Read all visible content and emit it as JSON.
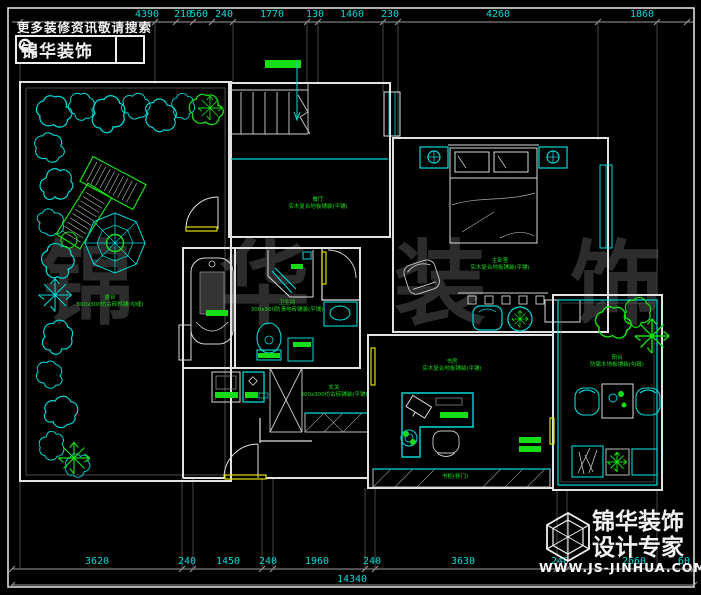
{
  "header": {
    "tagline": "更多装修资讯敬请搜索",
    "brand": "锦华装饰",
    "search_icon": "magnifier-icon"
  },
  "watermark": {
    "text": "锦华装饰",
    "chars": [
      "锦",
      "华",
      "装",
      "饰"
    ]
  },
  "footer": {
    "brand": "锦华装饰",
    "subtitle": "设计专家",
    "website": "WWW.JS-JINHUA.COM",
    "logo_icon": "cube-logo-icon"
  },
  "dimensions": {
    "top": [
      "4390",
      "210",
      "560",
      "240",
      "1770",
      "130",
      "1460",
      "230",
      "4260",
      "1860"
    ],
    "bottom": [
      "3620",
      "240",
      "1450",
      "240",
      "1960",
      "240",
      "3630",
      "240",
      "2660",
      "60"
    ],
    "total": "14340"
  },
  "rooms": {
    "terrace": {
      "name": "露台",
      "finish": "300x300仿古砖斜铺(勾缝)"
    },
    "dining": {
      "name": "餐厅",
      "finish": "实木复合地板铺装(平铺)"
    },
    "master_bedroom": {
      "name": "主卧室",
      "finish": "实木复合地板铺装(平铺)"
    },
    "bathroom": {
      "name": "卫生间",
      "finish": "300x300防滑地砖铺装(平铺)"
    },
    "hallway": {
      "name": "玄关",
      "finish": "300x300仿古砖铺装(平铺)"
    },
    "study": {
      "name": "书房",
      "finish": "实木复合地板铺装(平铺)"
    },
    "balcony": {
      "name": "阳台",
      "finish": "防腐木地板铺装(勾缝)"
    },
    "bookcase": {
      "name": "书柜(移门)"
    }
  },
  "colors": {
    "wall": "#e2e2e2",
    "furniture": "#00d8d8",
    "label_green": "#16dd16",
    "dimension_cyan": "#00d9d9",
    "accent_yellow": "#dede00",
    "watermark_gray": "#2c2c2c"
  }
}
